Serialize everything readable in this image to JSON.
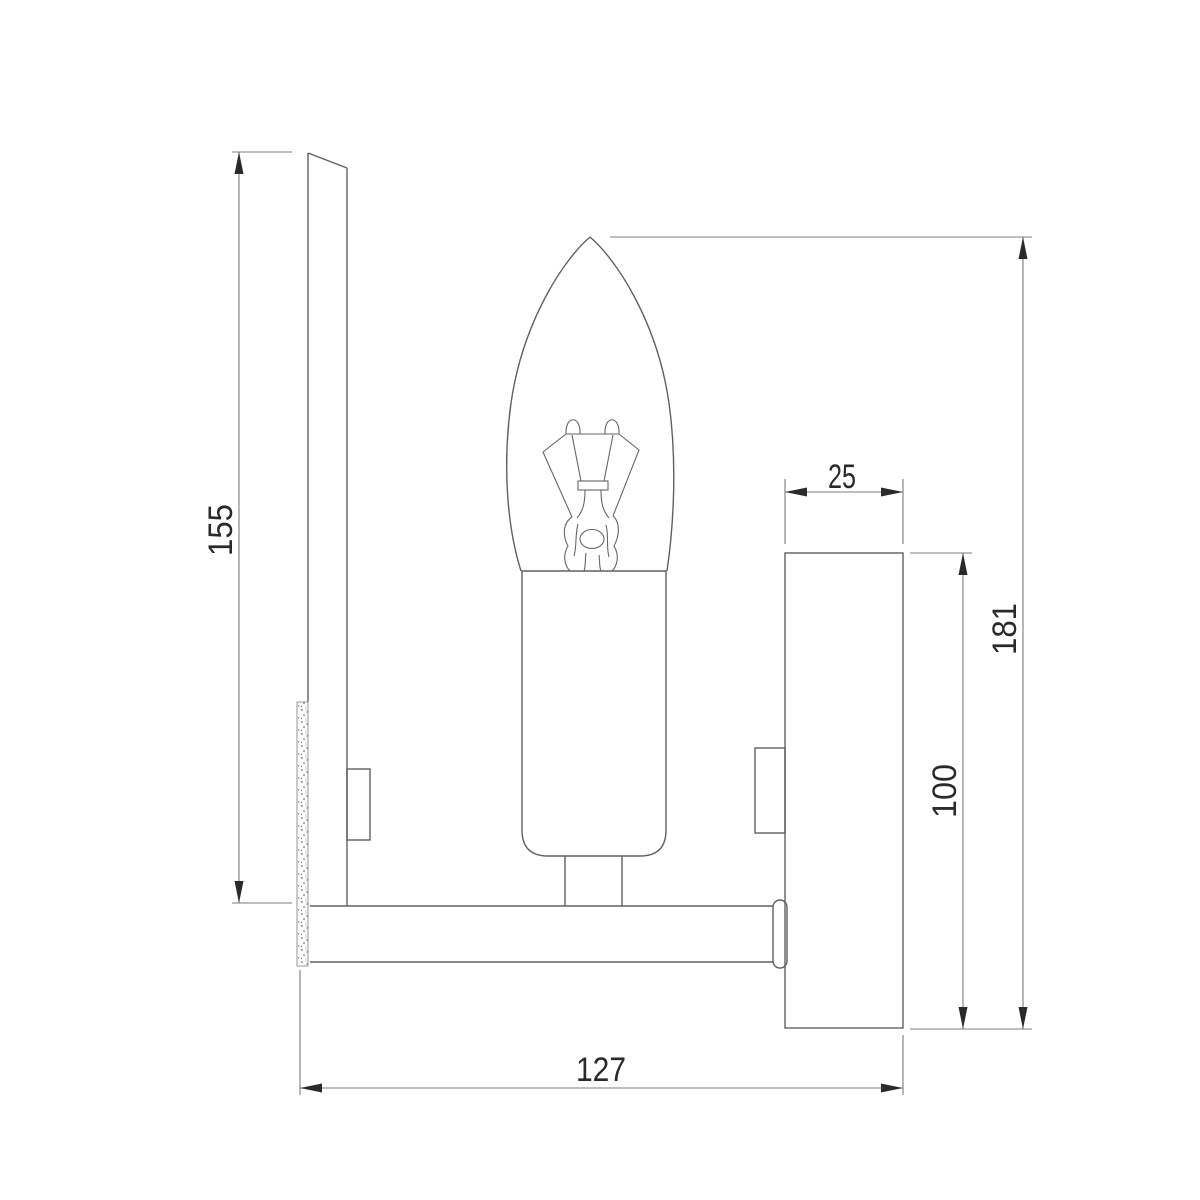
{
  "drawing": {
    "colors": {
      "background": "#ffffff",
      "outline": "#606060",
      "dimension_line": "#7d7d7d",
      "text": "#2a2a2a"
    },
    "dimensions": {
      "backplate_height": "155",
      "canopy_depth": "25",
      "overall_height": "181",
      "canopy_height": "100",
      "overall_depth": "127"
    }
  }
}
